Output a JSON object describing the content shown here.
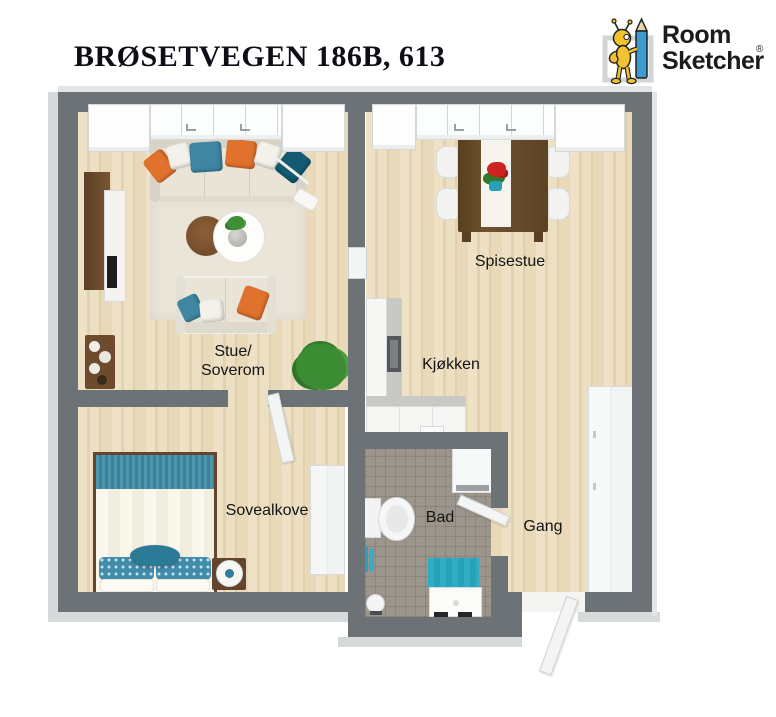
{
  "header": {
    "title": "BRØSETVEGEN 186B, 613",
    "logo": {
      "word1": "Room",
      "word2": "Sketcher",
      "registered": "®"
    }
  },
  "rooms": {
    "stue": {
      "line1": "Stue/",
      "line2": "Soverom"
    },
    "spisestue": {
      "label": "Spisestue"
    },
    "kjokken": {
      "label": "Kjøkken"
    },
    "sovealkove": {
      "label": "Sovealkove"
    },
    "bad": {
      "label": "Bad"
    },
    "gang": {
      "label": "Gang"
    }
  },
  "colors": {
    "wall_gray": "#6d7276",
    "wood_floor": "#e9dbbd",
    "bath_tile": "#9b958c",
    "accent_teal": "#3e86a2",
    "accent_dark_teal": "#135a72",
    "accent_orange": "#e1722e",
    "bed_teal": "#4b92aa",
    "mat_teal": "#2fadc4",
    "wood_furniture": "#6f4b2e",
    "logo_yellow": "#f2c230",
    "logo_blue": "#3b9ccf"
  }
}
